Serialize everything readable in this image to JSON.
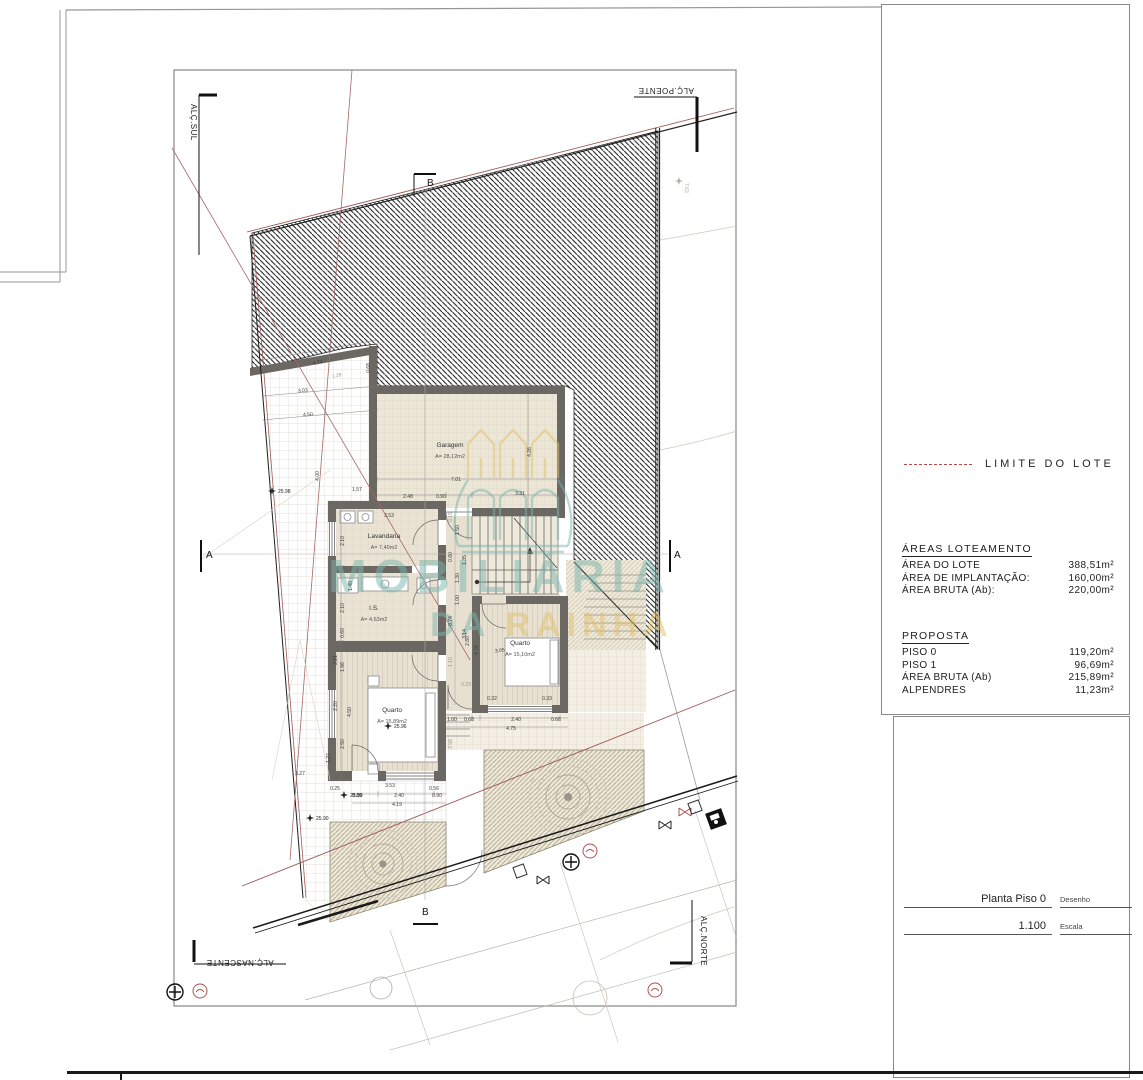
{
  "legend": {
    "limite_label": "LIMITE DO LOTE",
    "limite_color": "#b5494a"
  },
  "areas_loteamento": {
    "title": "ÁREAS LOTEAMENTO",
    "rows": [
      {
        "label": "ÁREA DO LOTE",
        "value": "388,51m²"
      },
      {
        "label": "ÁREA DE IMPLANTAÇÃO:",
        "value": "160,00m²"
      },
      {
        "label": "ÁREA BRUTA (Ab):",
        "value": "220,00m²"
      }
    ]
  },
  "proposta": {
    "title": "PROPOSTA",
    "rows": [
      {
        "label": "PISO 0",
        "value": "119,20m²"
      },
      {
        "label": "PISO 1",
        "value": "96,69m²"
      },
      {
        "label": "ÁREA BRUTA (Ab)",
        "value": "215,89m²"
      },
      {
        "label": "ALPENDRES",
        "value": "11,23m²"
      }
    ]
  },
  "titleblock": {
    "drawing_name": "Planta Piso 0",
    "drawing_label": "Desenho",
    "scale_value": "1.100",
    "scale_label": "Escala"
  },
  "elevation_labels": {
    "sul": "ALÇ.SUL",
    "poente": "ALÇ.POENTE",
    "nascente": "ALÇ.NASCENTE",
    "norte": "ALÇ.NORTE"
  },
  "section_markers": {
    "a": "A",
    "b": "B"
  },
  "watermark": {
    "line1": "MOBILIÁRIA",
    "line2_a": "DA ",
    "line2_b": "RAINHA",
    "teal": "#7ab5ac",
    "yellow": "#e2c169"
  },
  "icons": {
    "tree-icon": "concentric circles",
    "valve-icon": "bowtie cross",
    "survey-point-icon": "circled plus",
    "utility-red-icon": "red circle",
    "utility-box-icon": "black square",
    "manhole-icon": "plain circle"
  },
  "plan": {
    "rooms": [
      {
        "name": "Garagem",
        "area": "A= 28,12m2",
        "x": 450,
        "y": 447
      },
      {
        "name": "Lavandaria",
        "area": "A= 7,40m2",
        "x": 384,
        "y": 538
      },
      {
        "name": "I.S.",
        "area": "A= 4,63m2",
        "x": 374,
        "y": 610
      },
      {
        "name": "Quarto",
        "area": "A= 15,89m2",
        "x": 392,
        "y": 712
      },
      {
        "name": "Quarto",
        "area": "A= 15,10m2",
        "x": 520,
        "y": 645
      }
    ],
    "spots": [
      {
        "t": "25.98",
        "x": 272,
        "y": 491
      },
      {
        "t": "25.96",
        "x": 388,
        "y": 726
      },
      {
        "t": "25.90",
        "x": 344,
        "y": 795
      },
      {
        "t": "25.90",
        "x": 310,
        "y": 818
      },
      {
        "t": "7.63",
        "x": 679,
        "y": 181,
        "r": 90,
        "f": 1
      }
    ],
    "dims": [
      {
        "t": "7.01",
        "x": 456,
        "y": 481
      },
      {
        "t": "2.48",
        "x": 408,
        "y": 498
      },
      {
        "t": "0.90",
        "x": 441,
        "y": 498
      },
      {
        "t": "3.31",
        "x": 520,
        "y": 495
      },
      {
        "t": "4.26",
        "x": 531,
        "y": 452,
        "r": -90
      },
      {
        "t": "4.74",
        "x": 318,
        "y": 364,
        "r": -10
      },
      {
        "t": "1.29",
        "x": 337,
        "y": 377,
        "r": -10,
        "f": 1
      },
      {
        "t": "3.03",
        "x": 303,
        "y": 392,
        "r": -4
      },
      {
        "t": "4.50",
        "x": 308,
        "y": 416,
        "r": -3
      },
      {
        "t": "0.68",
        "x": 370,
        "y": 368,
        "r": -90
      },
      {
        "t": "4.00",
        "x": 319,
        "y": 476,
        "r": -90
      },
      {
        "t": "1.57",
        "x": 357,
        "y": 491
      },
      {
        "t": "3.53",
        "x": 389,
        "y": 517
      },
      {
        "t": "0.15",
        "x": 452,
        "y": 517,
        "r": -90,
        "f": 1
      },
      {
        "t": "2.10",
        "x": 344,
        "y": 541,
        "r": -90
      },
      {
        "t": "1.50",
        "x": 459,
        "y": 530,
        "r": -90
      },
      {
        "t": "0.80",
        "x": 452,
        "y": 557,
        "r": -90
      },
      {
        "t": "1.35",
        "x": 466,
        "y": 560,
        "r": -90
      },
      {
        "t": "1.40",
        "x": 352,
        "y": 586,
        "r": -90
      },
      {
        "t": "2.10",
        "x": 344,
        "y": 608,
        "r": -90
      },
      {
        "t": "0.60",
        "x": 344,
        "y": 633,
        "r": -90
      },
      {
        "t": "0.74",
        "x": 452,
        "y": 621,
        "r": -90
      },
      {
        "t": "3.14",
        "x": 466,
        "y": 634,
        "r": -90
      },
      {
        "t": "1.96",
        "x": 344,
        "y": 667,
        "r": -90
      },
      {
        "t": "2.21",
        "x": 337,
        "y": 660,
        "r": -90
      },
      {
        "t": "4.50",
        "x": 351,
        "y": 712,
        "r": -90
      },
      {
        "t": "2.20",
        "x": 337,
        "y": 706,
        "r": -90
      },
      {
        "t": "2.50",
        "x": 344,
        "y": 744,
        "r": -90
      },
      {
        "t": "3.58",
        "x": 452,
        "y": 744,
        "r": -90,
        "f": 1
      },
      {
        "t": "1.27",
        "x": 330,
        "y": 758,
        "r": -90
      },
      {
        "t": "3.27",
        "x": 300,
        "y": 775
      },
      {
        "t": "3.53",
        "x": 390,
        "y": 787
      },
      {
        "t": "0.56",
        "x": 434,
        "y": 790
      },
      {
        "t": "0.25",
        "x": 335,
        "y": 790
      },
      {
        "t": "0.89",
        "x": 357,
        "y": 797
      },
      {
        "t": "2.40",
        "x": 399,
        "y": 797
      },
      {
        "t": "0.90",
        "x": 437,
        "y": 797
      },
      {
        "t": "4.19",
        "x": 397,
        "y": 806
      },
      {
        "t": "1.00",
        "x": 452,
        "y": 721
      },
      {
        "t": "0.68",
        "x": 469,
        "y": 721
      },
      {
        "t": "2.40",
        "x": 516,
        "y": 721
      },
      {
        "t": "0.66",
        "x": 556,
        "y": 721
      },
      {
        "t": "4.75",
        "x": 511,
        "y": 730
      },
      {
        "t": "3.05",
        "x": 500,
        "y": 652,
        "r": -8
      },
      {
        "t": "4.79",
        "x": 478,
        "y": 650,
        "r": -90
      },
      {
        "t": "2.80",
        "x": 469,
        "y": 641,
        "r": -90
      },
      {
        "t": "1.30",
        "x": 459,
        "y": 578,
        "r": -90
      },
      {
        "t": "1.00",
        "x": 459,
        "y": 600,
        "r": -90
      },
      {
        "t": "0.32",
        "x": 492,
        "y": 700
      },
      {
        "t": "0.33",
        "x": 547,
        "y": 700
      },
      {
        "t": "0.23",
        "x": 466,
        "y": 686,
        "f": 1
      },
      {
        "t": "1.10",
        "x": 452,
        "y": 662,
        "r": -90,
        "f": 1
      }
    ]
  }
}
